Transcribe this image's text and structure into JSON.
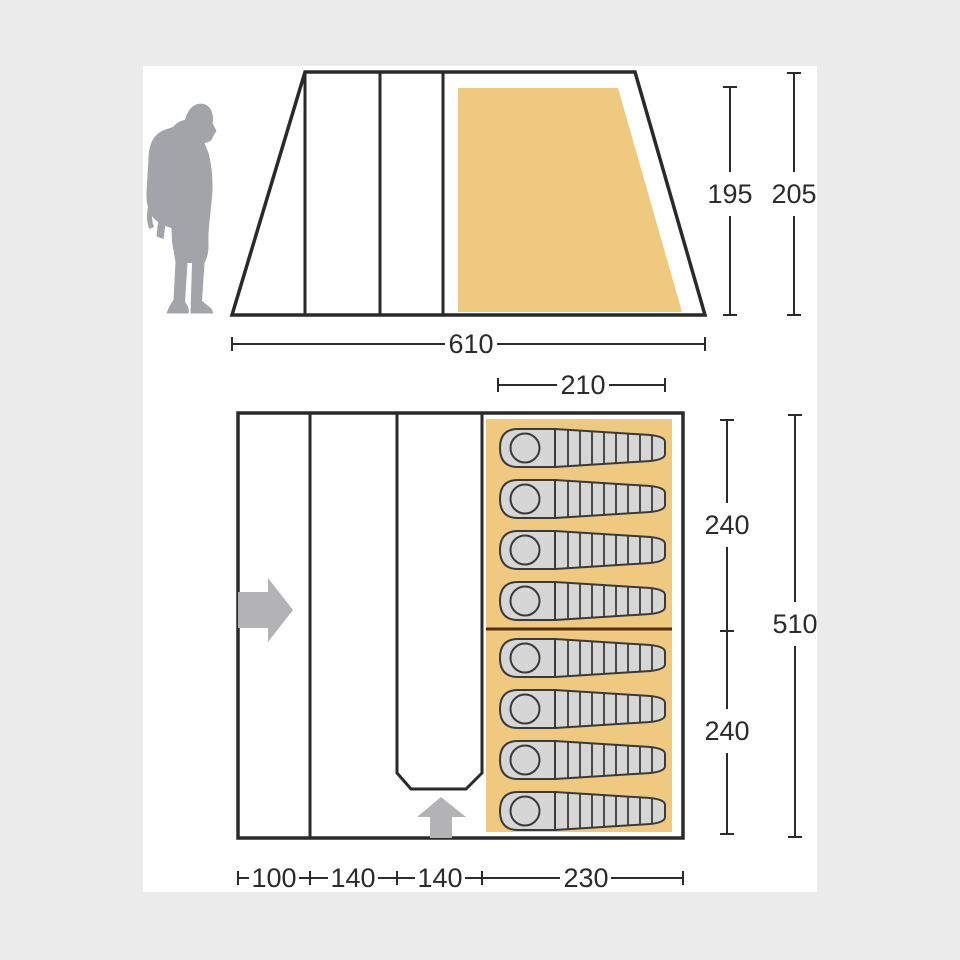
{
  "diagram": {
    "side_view": {
      "inner_height": "195",
      "outer_height": "205",
      "total_width": "610"
    },
    "floor_plan": {
      "bedroom_width": "210",
      "bedroom_depth_front": "240",
      "bedroom_depth_rear": "240",
      "total_depth": "510",
      "porch_section_width": "100",
      "living_section_width_1": "140",
      "living_section_width_2": "140",
      "bedroom_section_width": "230",
      "sleeping_bag_count": 8
    },
    "colors": {
      "background": "#ebebec",
      "panel": "#ffffff",
      "line": "#2a2a2a",
      "bedroom_fill": "#f0c981",
      "sleeping_bag_fill": "#d6d6d7",
      "figure_gray": "#a2a4aa",
      "arrow_gray": "#b3b3b5",
      "bedroom_divider": "#52300f"
    }
  }
}
